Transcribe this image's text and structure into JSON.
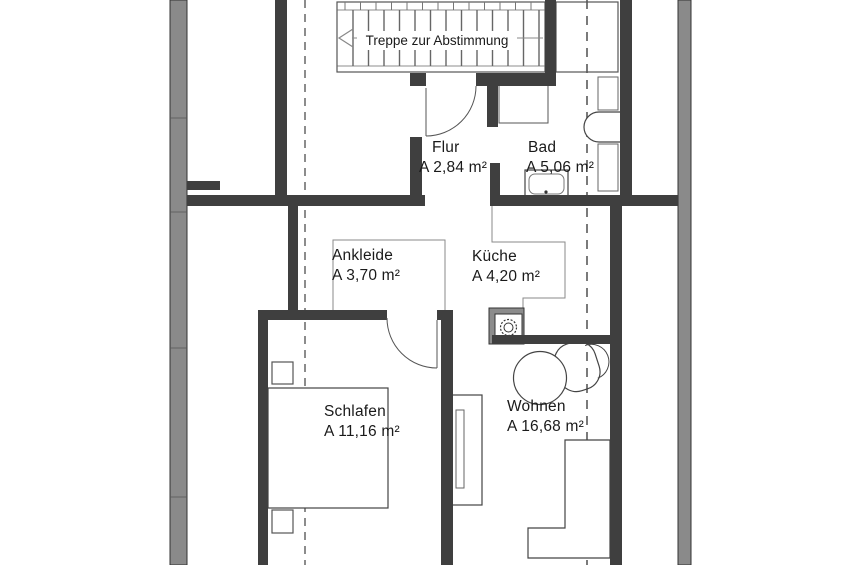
{
  "stairs": {
    "note": "Treppe zur Abstimmung"
  },
  "rooms": {
    "flur": {
      "name": "Flur",
      "area": "A 2,84 m²"
    },
    "bad": {
      "name": "Bad",
      "area": "A 5,06 m²"
    },
    "ankleide": {
      "name": "Ankleide",
      "area": "A 3,70 m²"
    },
    "kueche": {
      "name": "Küche",
      "area": "A 4,20 m²"
    },
    "schlafen": {
      "name": "Schlafen",
      "area": "A 11,16 m²"
    },
    "wohnen": {
      "name": "Wohnen",
      "area": "A 16,68 m²"
    }
  },
  "colors": {
    "wall_interior": "#3f3f3f",
    "wall_exterior": "#8a8a8a",
    "line": "#444444",
    "dashed_line_left": "#8c8c8c",
    "dashed_line_right": "#5a5a5a",
    "background": "#ffffff",
    "text": "#1a1a1a"
  },
  "fixtures": {
    "list": [
      "staircase",
      "shaft",
      "shower",
      "bathtub",
      "cabinet",
      "cabinet",
      "washbasin",
      "stove",
      "dining-table",
      "chair",
      "wardrobe",
      "sofa",
      "bed",
      "nightstand",
      "nightstand"
    ]
  }
}
